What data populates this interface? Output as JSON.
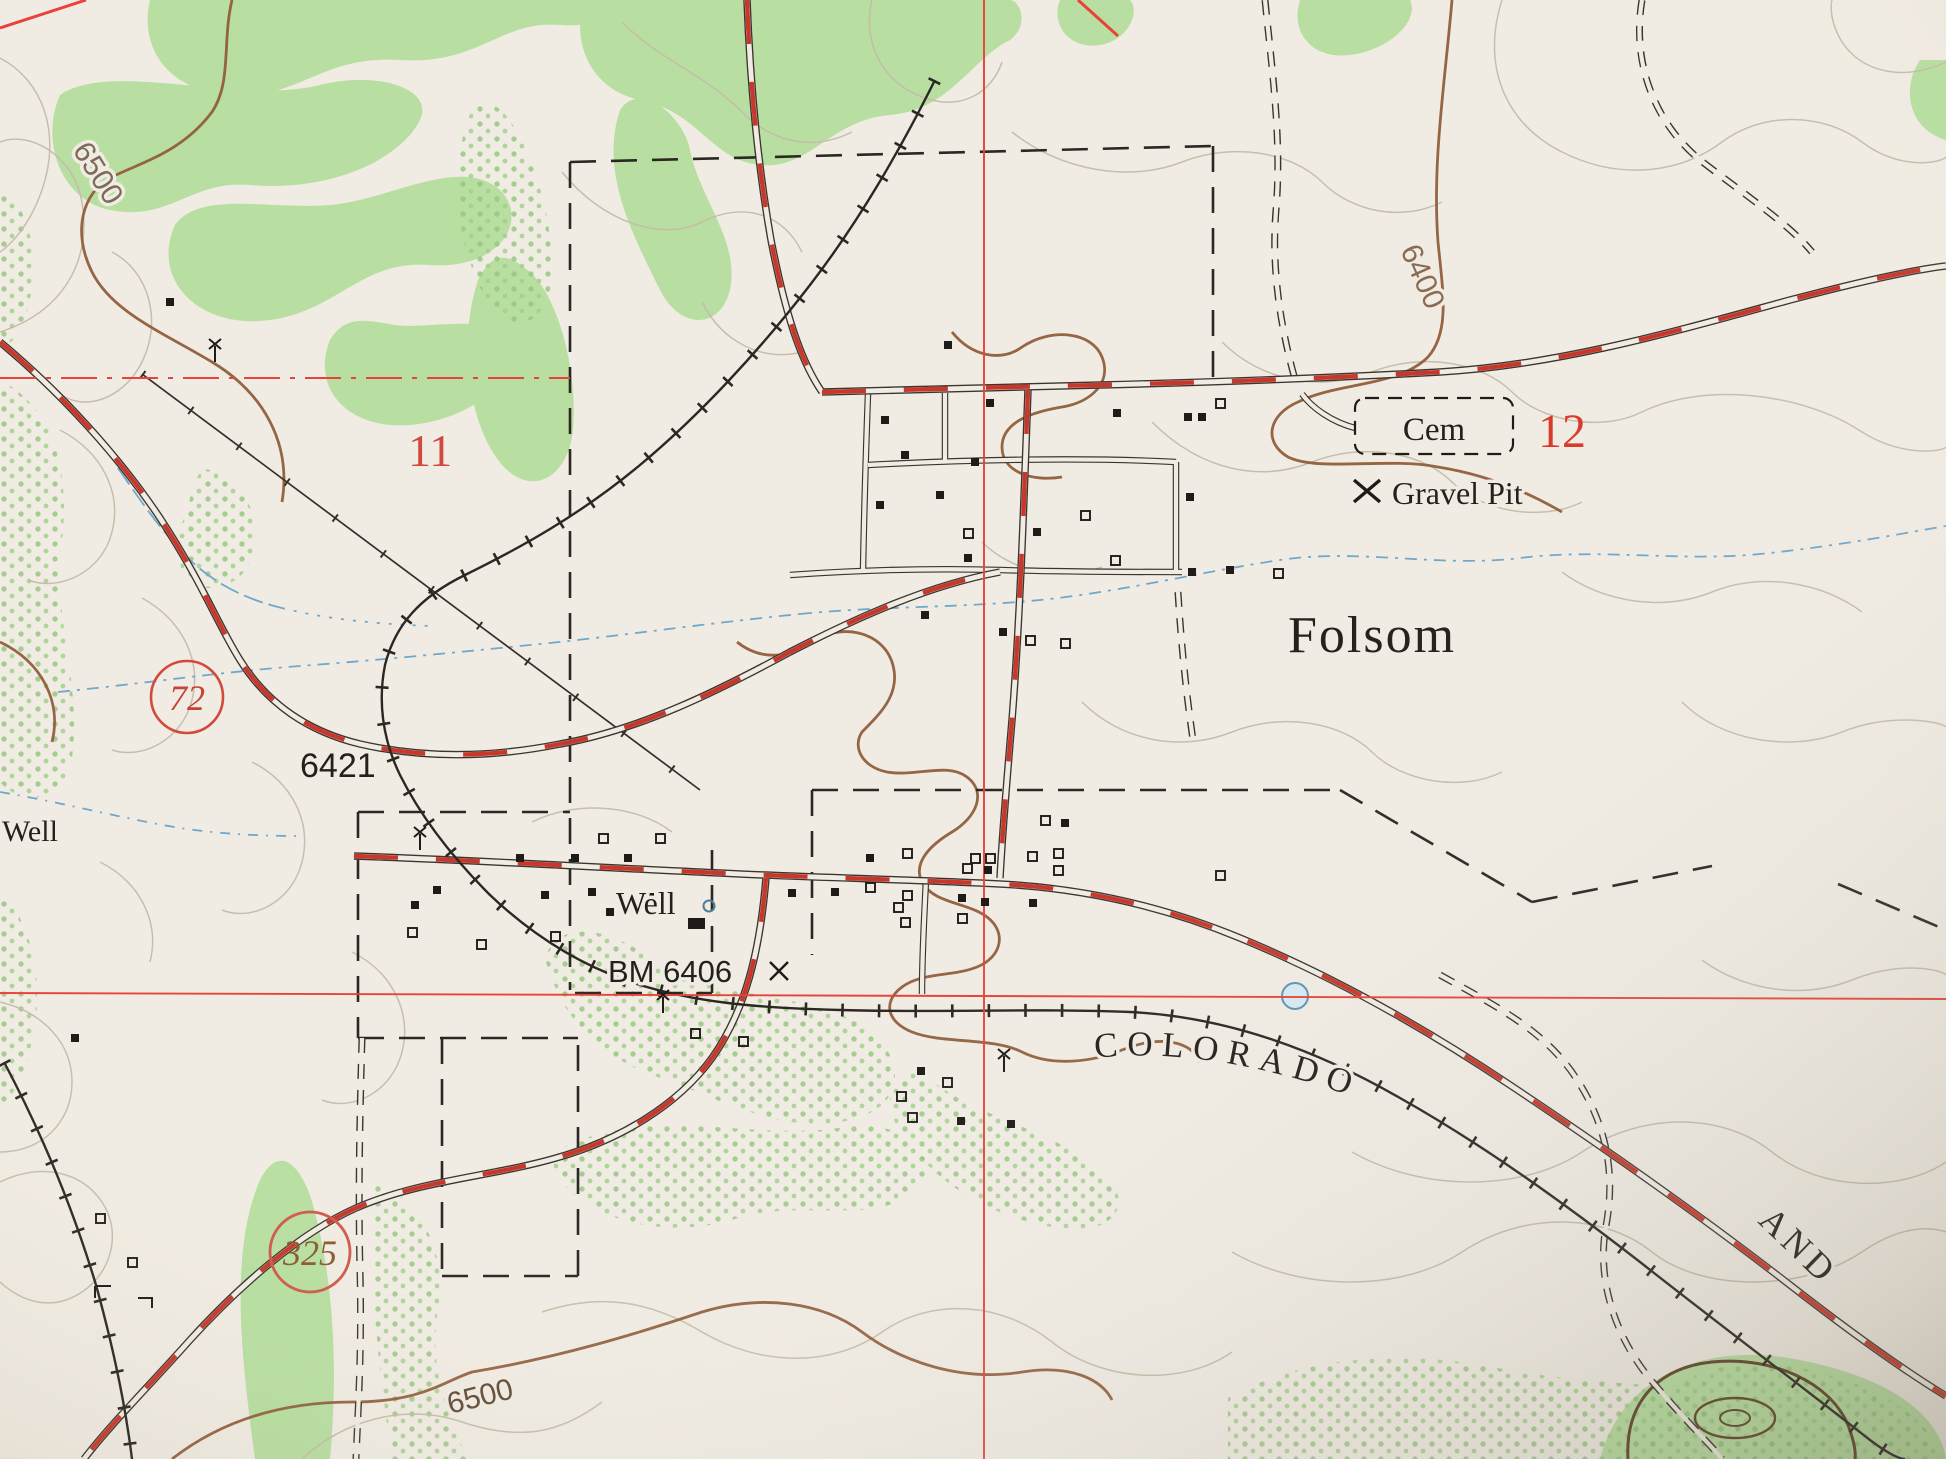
{
  "map": {
    "labels": {
      "town": "Folsom",
      "cemetery": "Cem",
      "gravel_pit": "Gravel Pit",
      "section_11": "11",
      "section_12": "12",
      "route_72": "72",
      "route_325": "325",
      "well_center": "Well",
      "well_left": "Well",
      "benchmark": "BM 6406",
      "railroad_elev": "6421",
      "railroad_name_1": "COLORADO",
      "railroad_name_2": "AND",
      "contour_6500_nw": "6500",
      "contour_6400_ne": "6400",
      "contour_6500_sw": "6500"
    },
    "colors": {
      "paper": "#f1ece3",
      "woodland": "#b8dfa1",
      "woodland_dots": "#93c67d",
      "contour_light": "#c6bba9",
      "contour_index": "#8f5e3b",
      "road_red": "#c8372b",
      "section_red": "#e8423a",
      "water_blue": "#6fa8cc",
      "ink": "#262320"
    }
  }
}
